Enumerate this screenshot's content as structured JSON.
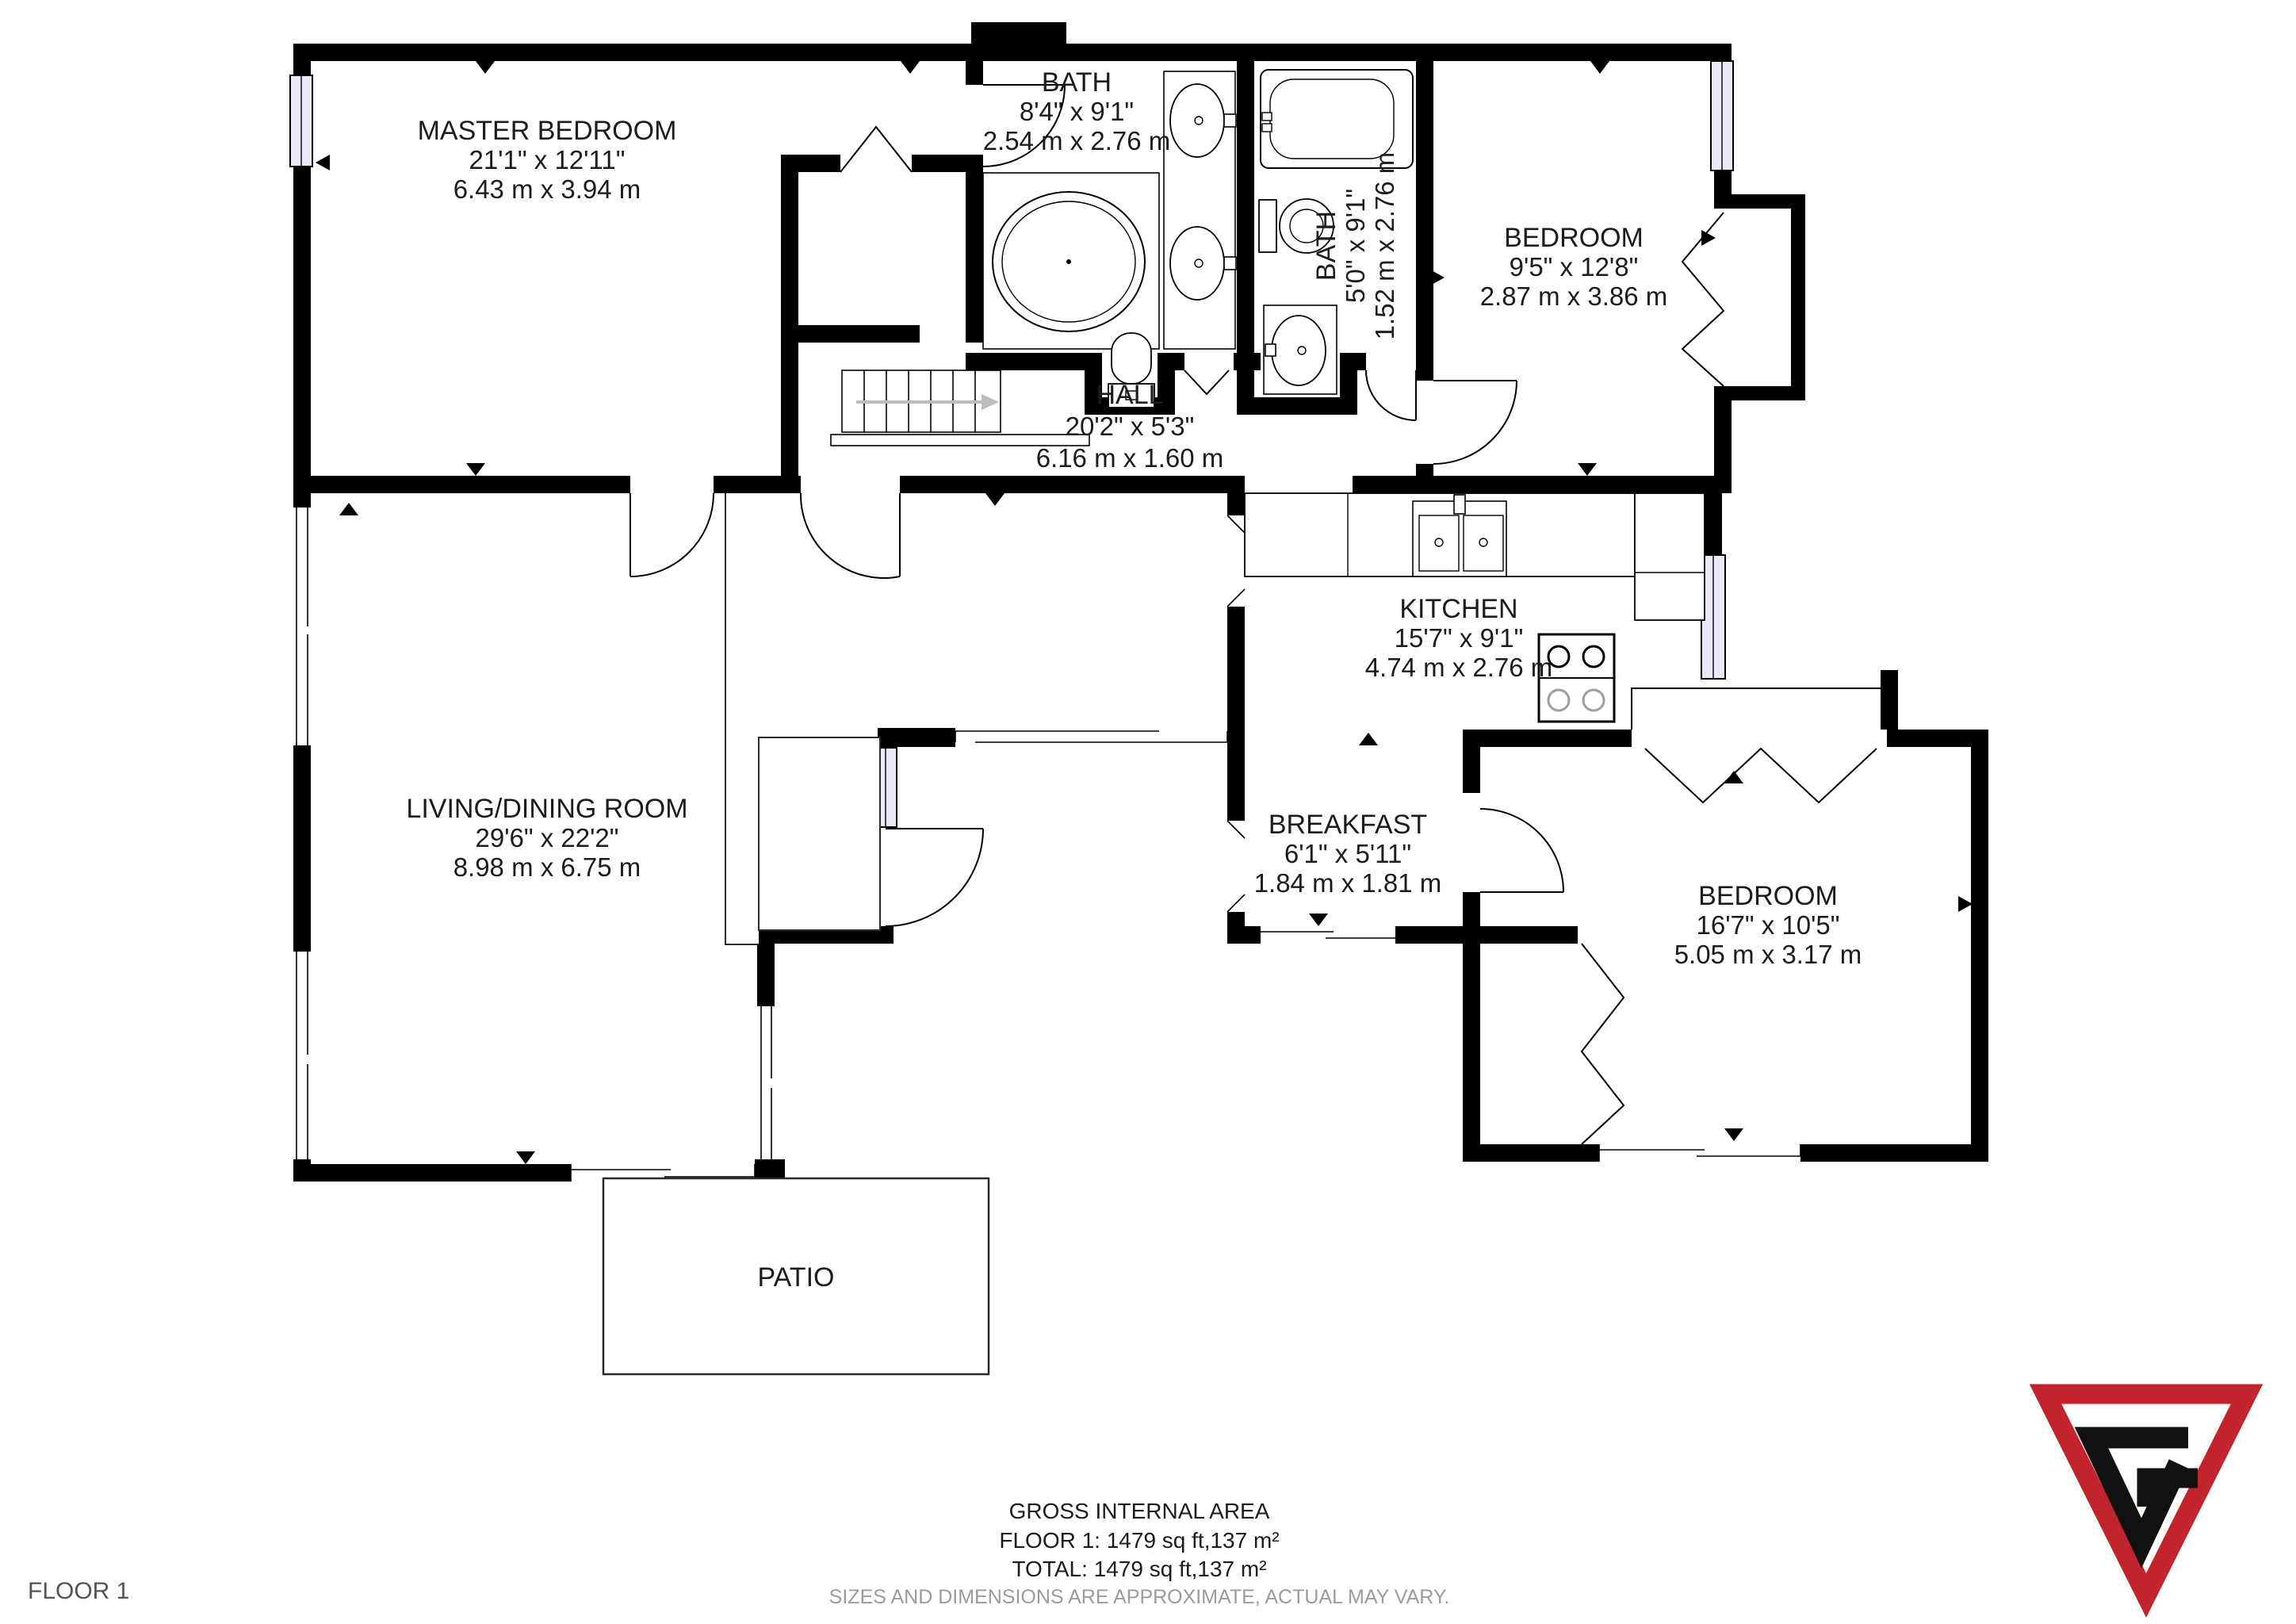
{
  "page": {
    "floor_label": "FLOOR 1"
  },
  "rooms": [
    {
      "name": "MASTER BEDROOM",
      "imperial": "21'1\" x 12'11\"",
      "metric": "6.43 m x 3.94 m"
    },
    {
      "name": "BATH",
      "imperial": "8'4\" x 9'1\"",
      "metric": "2.54 m x 2.76 m"
    },
    {
      "name": "BATH",
      "imperial": "5'0\" x 9'1\"",
      "metric": "1.52 m x 2.76 m"
    },
    {
      "name": "BEDROOM",
      "imperial": "9'5\" x 12'8\"",
      "metric": "2.87 m x 3.86 m"
    },
    {
      "name": "HALL",
      "imperial": "20'2\" x 5'3\"",
      "metric": "6.16 m x 1.60 m"
    },
    {
      "name": "KITCHEN",
      "imperial": "15'7\" x 9'1\"",
      "metric": "4.74 m x 2.76 m"
    },
    {
      "name": "LIVING/DINING ROOM",
      "imperial": "29'6\" x 22'2\"",
      "metric": "8.98 m x 6.75 m"
    },
    {
      "name": "BREAKFAST",
      "imperial": "6'1\" x 5'11\"",
      "metric": "1.84 m x 1.81 m"
    },
    {
      "name": "BEDROOM",
      "imperial": "16'7\" x 10'5\"",
      "metric": "5.05 m x 3.17 m"
    },
    {
      "name": "PATIO"
    }
  ],
  "footer": {
    "gross": "GROSS INTERNAL AREA",
    "floor": "FLOOR 1: 1479 sq ft,137 m²",
    "total": "TOTAL: 1479 sq ft,137 m²",
    "disclaimer": "SIZES AND DIMENSIONS ARE APPROXIMATE, ACTUAL MAY VARY."
  },
  "colors": {
    "wall": "#000000",
    "window": "#E9E9F7",
    "logo_red": "#C2242C",
    "muted": "#9b9b9b"
  }
}
